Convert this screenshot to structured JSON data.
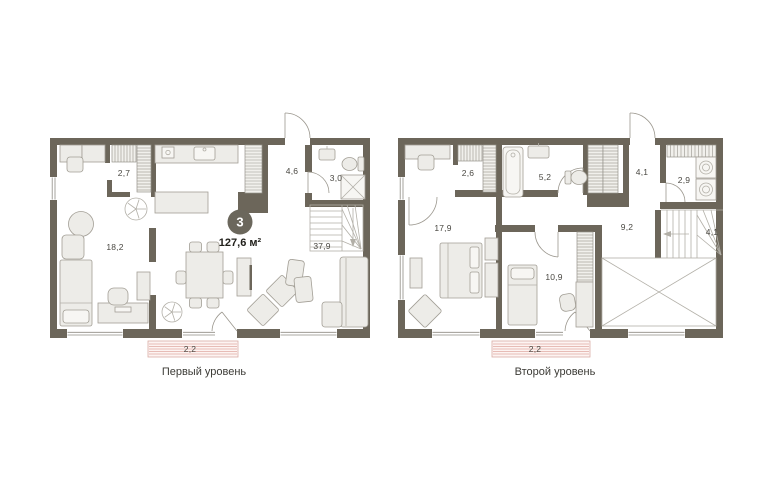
{
  "unit": {
    "badge": "3",
    "area": "127,6 м²"
  },
  "levels": [
    {
      "caption": "Первый уровень",
      "rooms": [
        {
          "name": "closet",
          "label": "2,7"
        },
        {
          "name": "hallway",
          "label": "4,6"
        },
        {
          "name": "bathroom",
          "label": "3,0"
        },
        {
          "name": "bedroom",
          "label": "18,2"
        },
        {
          "name": "living-kitchen",
          "label": "37,9"
        },
        {
          "name": "balcony",
          "label": "2,2"
        }
      ]
    },
    {
      "caption": "Второй уровень",
      "rooms": [
        {
          "name": "closet",
          "label": "2,6"
        },
        {
          "name": "bathroom",
          "label": "5,2"
        },
        {
          "name": "hall",
          "label": "4,1"
        },
        {
          "name": "laundry",
          "label": "2,9"
        },
        {
          "name": "bedroom",
          "label": "17,9"
        },
        {
          "name": "corridor",
          "label": "9,2"
        },
        {
          "name": "stairs",
          "label": "4,1"
        },
        {
          "name": "bedroom-2",
          "label": "10,9"
        },
        {
          "name": "balcony",
          "label": "2,2"
        }
      ]
    }
  ],
  "colors": {
    "wall": "#6c665a",
    "balcony_stripe": "#e7bcb6",
    "badge": "#6b675c"
  }
}
